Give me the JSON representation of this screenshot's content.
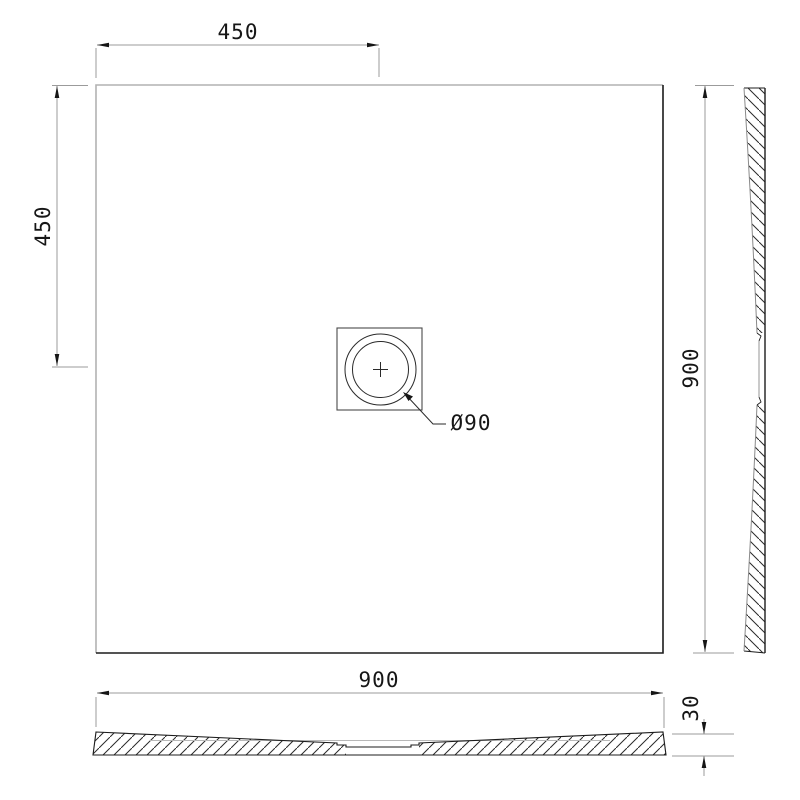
{
  "watermark": {
    "text": "maxaro",
    "registered_mark": "®"
  },
  "plan_view": {
    "drain_offset_x_dim": "450",
    "drain_offset_y_dim": "450",
    "height_full_dim": "900",
    "drain_diameter_dim": "Ø90"
  },
  "bottom_section_view": {
    "width_full_dim": "900",
    "thickness_dim": "30"
  },
  "colors": {
    "outline_gray": "#b2b2b2",
    "outline_dark": "#1c1c1c",
    "dimension_line_gray": "#9b9b9b",
    "arrow_and_text": "#161616",
    "hatch": "#2a2a2a",
    "watermark": "#ededed"
  }
}
